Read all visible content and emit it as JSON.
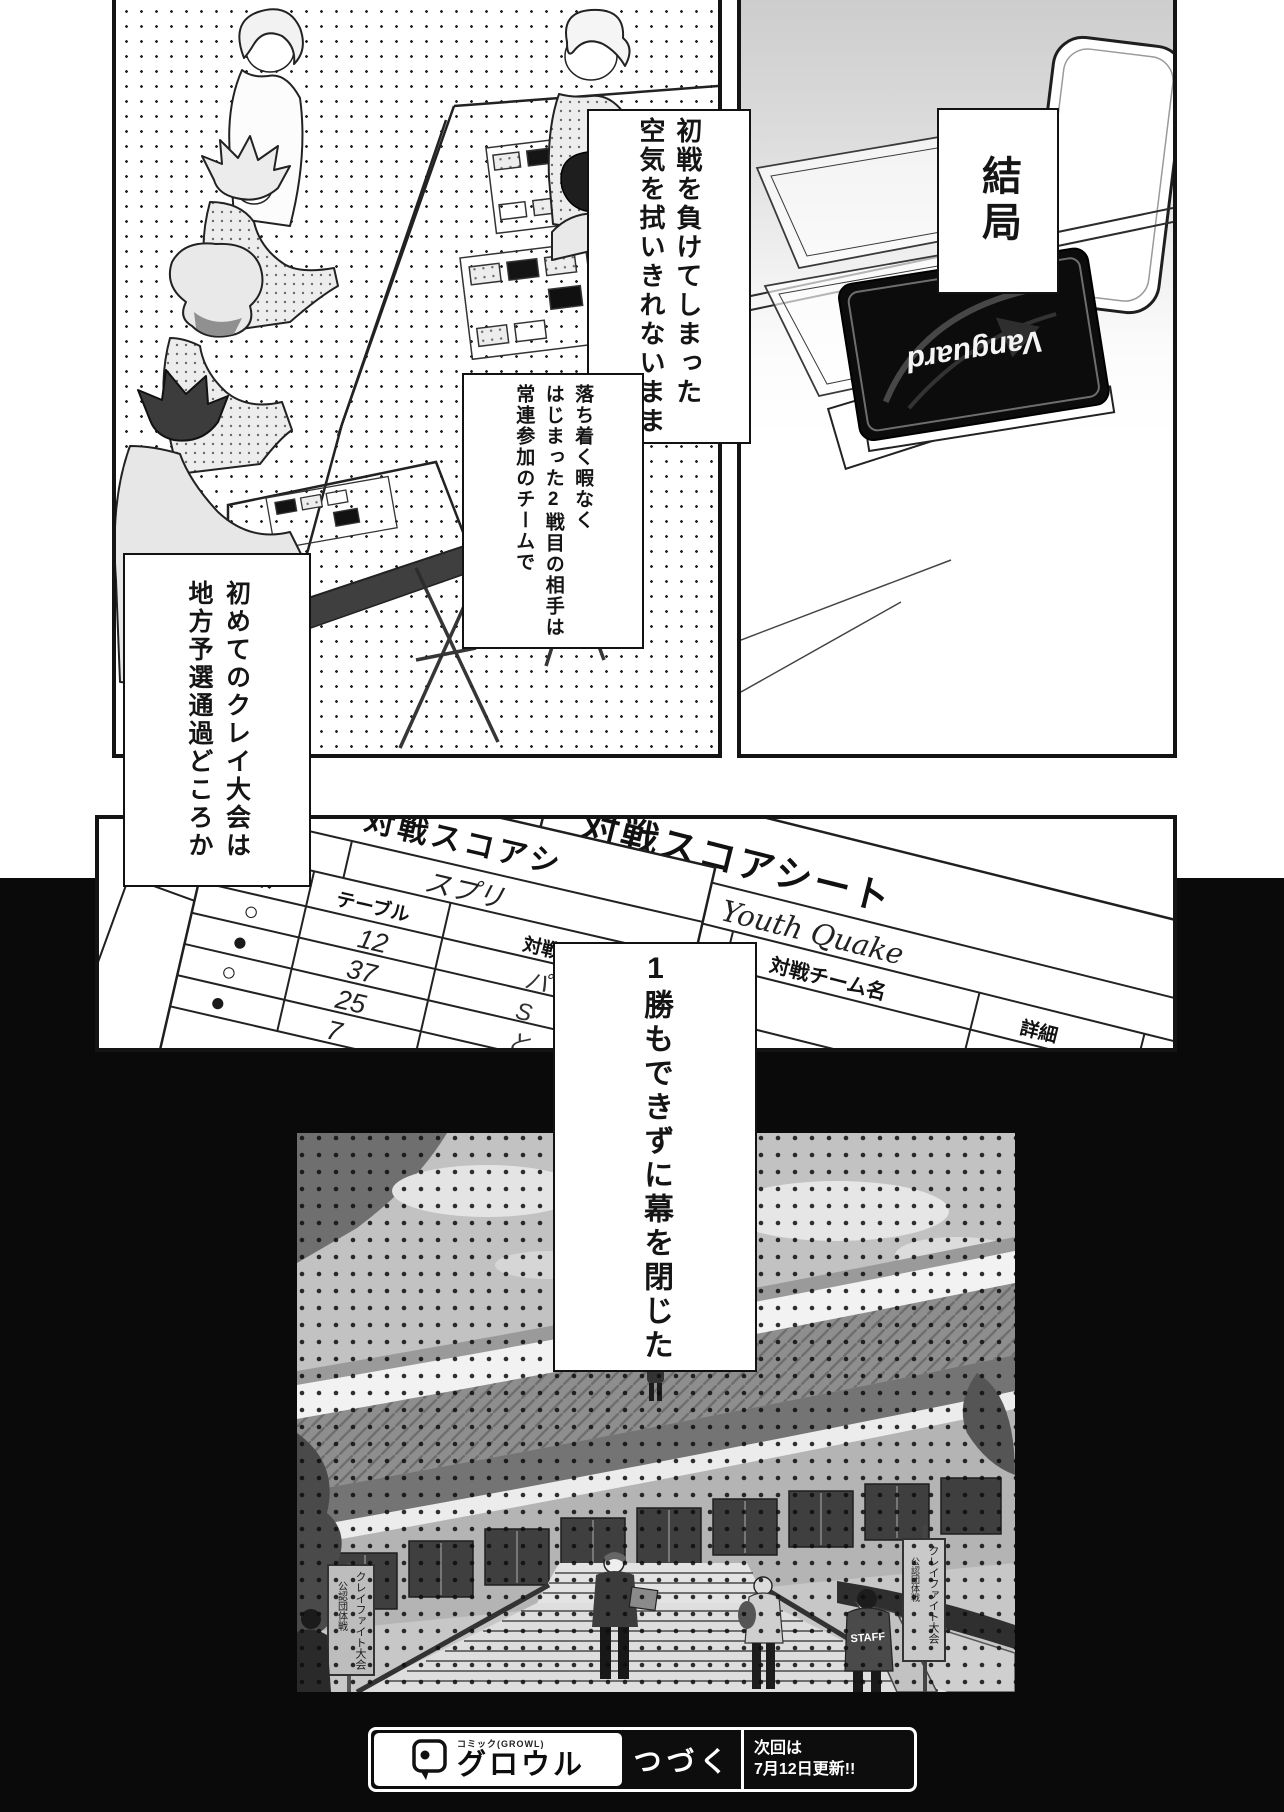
{
  "narration": {
    "kekkyoku": "結局",
    "box1_col1": "初戦を負けてしまった",
    "box1_col2": "空気を拭いきれないまま",
    "box2_col1": "落ち着く暇なく",
    "box2_col2": "はじまった2戦目の相手は",
    "box2_col3": "常連参加のチームで",
    "box3_col1": "初めてのクレイ大会は",
    "box3_col2": "地方予選通過どころか",
    "box4_col1": "1勝もできずに幕を閉じた"
  },
  "card_deck": {
    "brand": "Vanguard"
  },
  "score_panel": {
    "sheet_left": {
      "title": "対戦スコアシ",
      "team_label": "チーム名",
      "team_name": "スプリ",
      "col_result": "結果",
      "col_table": "テーブル",
      "col_opponent": "対戦",
      "rows": [
        {
          "result": "○",
          "table": "12",
          "opponent": "パ"
        },
        {
          "result": "●",
          "table": "37",
          "opponent": "S"
        },
        {
          "result": "○",
          "table": "25",
          "opponent": "と"
        },
        {
          "result": "●",
          "table": "7",
          "opponent": "ガッチマン"
        }
      ]
    },
    "sheet_right": {
      "title": "対戦スコアシート",
      "team_label": "チーム名",
      "team_name": "Youth Quake",
      "col_result": "結果",
      "col_table": "テーブル",
      "col_opponent": "対戦チーム名",
      "col_detail": "詳細",
      "rows": [
        {
          "result": "●",
          "table": "66"
        },
        {
          "result": "●",
          "table": "2"
        }
      ]
    }
  },
  "stadium": {
    "sign_left_line1": "クレイファイト大会",
    "sign_left_line2": "公認団体戦",
    "sign_right_line1": "クレイファイト大会",
    "sign_right_line2": "公認団体戦",
    "staff_label": "STAFF"
  },
  "footer": {
    "brand_reading": "コミック",
    "brand_sub": "(GROWL)",
    "brand": "グロウル",
    "continue_label": "つづく",
    "next_line1": "次回は",
    "next_line2": "7月12日更新!!"
  }
}
